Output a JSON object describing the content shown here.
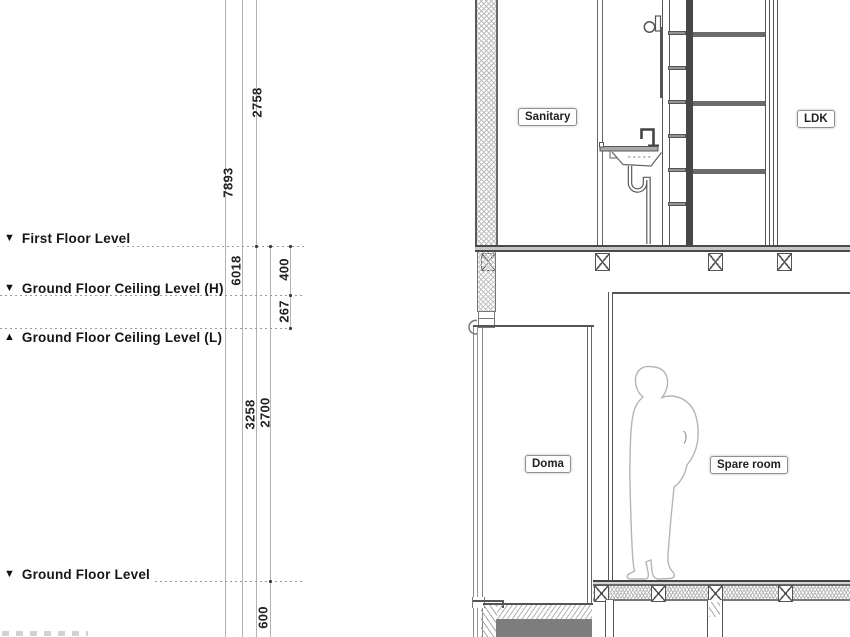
{
  "drawing": {
    "type": "architectural-section",
    "levels": [
      {
        "marker": "▼",
        "label": "First Floor Level"
      },
      {
        "marker": "▼",
        "label": "Ground Floor Ceiling Level (H)"
      },
      {
        "marker": "▲",
        "label": "Ground Floor Ceiling Level (L)"
      },
      {
        "marker": "▼",
        "label": "Ground Floor Level"
      }
    ],
    "dimensions_mm": [
      "2758",
      "7893",
      "6018",
      "400",
      "267",
      "3258",
      "2700",
      "600"
    ],
    "rooms": [
      {
        "label": "Sanitary"
      },
      {
        "label": "LDK"
      },
      {
        "label": "Doma"
      },
      {
        "label": "Spare room"
      }
    ],
    "colors": {
      "background": "#ffffff",
      "building_line": "#555555",
      "dimension_line": "#b3b3b3",
      "slab_fill": "#c6c6c6",
      "foundation_fill": "#7d7d7d",
      "figure_outline": "#b5b5b5"
    }
  }
}
